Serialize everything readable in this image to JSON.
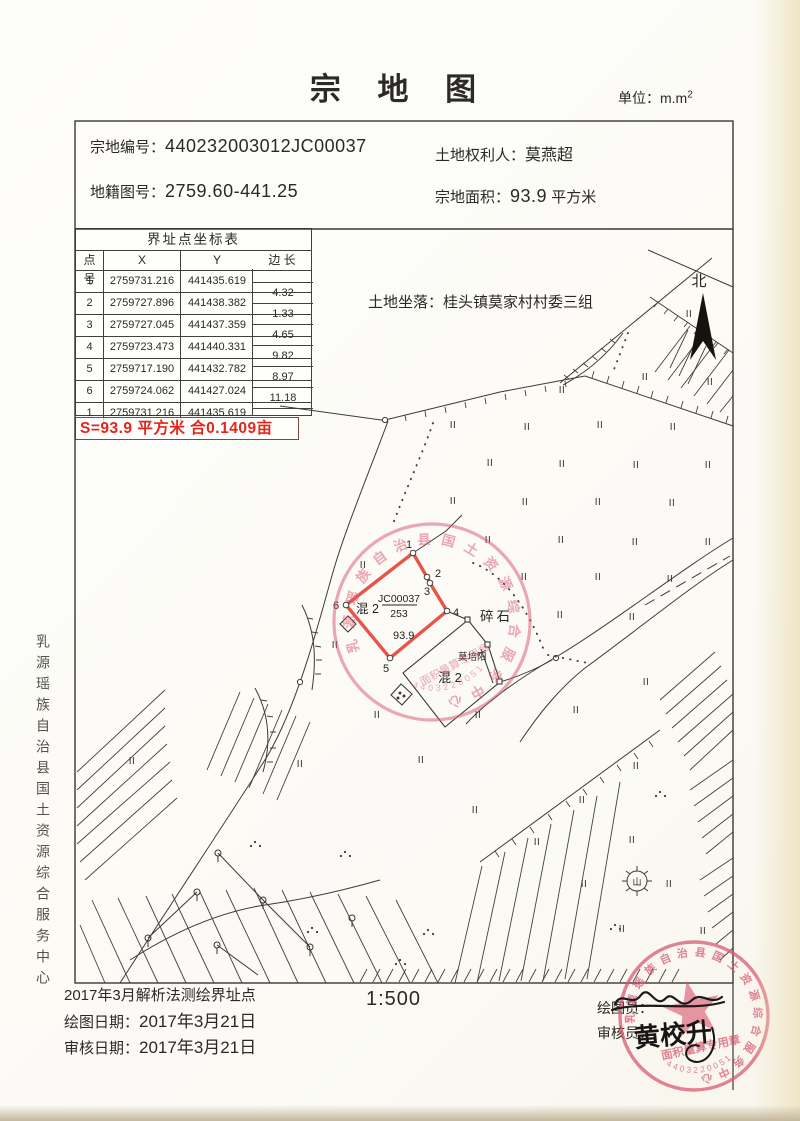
{
  "page": {
    "title": "宗 地 图",
    "unit_label": "单位：m.m",
    "unit_sup": "2"
  },
  "header": {
    "parcel_no_label": "宗地编号：",
    "parcel_no": "440232003012JC00037",
    "holder_label": "土地权利人：",
    "holder": "莫燕超",
    "sheet_no_label": "地籍图号：",
    "sheet_no": "2759.60-441.25",
    "area_label": "宗地面积：",
    "area": "93.9",
    "area_unit": "平方米"
  },
  "table": {
    "title": "界址点坐标表",
    "headers": {
      "pt": "点 号",
      "x": "X",
      "y": "Y",
      "len": "边 长"
    },
    "rows": [
      {
        "pt": "1",
        "x": "2759731.216",
        "y": "441435.619"
      },
      {
        "pt": "2",
        "x": "2759727.896",
        "y": "441438.382"
      },
      {
        "pt": "3",
        "x": "2759727.045",
        "y": "441437.359"
      },
      {
        "pt": "4",
        "x": "2759723.473",
        "y": "441440.331"
      },
      {
        "pt": "5",
        "x": "2759717.190",
        "y": "441432.782"
      },
      {
        "pt": "6",
        "x": "2759724.062",
        "y": "441427.024"
      },
      {
        "pt": "1",
        "x": "2759731.216",
        "y": "441435.619"
      }
    ],
    "edge_lengths": [
      "4.32",
      "1.33",
      "4.65",
      "9.82",
      "8.97",
      "11.18"
    ],
    "summary": "S=93.9 平方米 合0.1409亩"
  },
  "map": {
    "location_label": "土地坐落：",
    "location": "桂头镇莫家村村委三组",
    "north_label": "北",
    "gravel_label": "碎石",
    "hill_label": "山",
    "ii_symbol": "II",
    "parcel": {
      "code": "JC00037",
      "denominator": "253",
      "structure": "混 2",
      "area": "93.9",
      "vertex_labels": [
        "1",
        "2",
        "3",
        "4",
        "5",
        "6"
      ]
    },
    "neighbor": {
      "owner": "莫培阳",
      "structure": "混 2"
    },
    "ii_positions": [
      [
        689,
        317
      ],
      [
        645,
        380
      ],
      [
        710,
        385
      ],
      [
        562,
        393
      ],
      [
        453,
        428
      ],
      [
        527,
        430
      ],
      [
        600,
        428
      ],
      [
        673,
        430
      ],
      [
        490,
        466
      ],
      [
        562,
        467
      ],
      [
        636,
        468
      ],
      [
        708,
        468
      ],
      [
        453,
        504
      ],
      [
        525,
        505
      ],
      [
        598,
        505
      ],
      [
        672,
        506
      ],
      [
        488,
        543
      ],
      [
        561,
        543
      ],
      [
        635,
        545
      ],
      [
        708,
        545
      ],
      [
        524,
        580
      ],
      [
        598,
        580
      ],
      [
        670,
        582
      ],
      [
        560,
        618
      ],
      [
        632,
        620
      ],
      [
        576,
        713
      ],
      [
        646,
        685
      ],
      [
        636,
        769
      ],
      [
        582,
        803
      ],
      [
        537,
        845
      ],
      [
        632,
        843
      ],
      [
        584,
        887
      ],
      [
        669,
        887
      ],
      [
        622,
        932
      ],
      [
        703,
        934
      ],
      [
        478,
        718
      ],
      [
        421,
        763
      ],
      [
        475,
        813
      ],
      [
        363,
        568
      ],
      [
        335,
        648
      ],
      [
        300,
        767
      ],
      [
        377,
        718
      ],
      [
        132,
        764
      ]
    ],
    "poles": [
      [
        218,
        853
      ],
      [
        197,
        892
      ],
      [
        148,
        938
      ],
      [
        217,
        945
      ],
      [
        263,
        900
      ],
      [
        310,
        947
      ],
      [
        352,
        918
      ]
    ],
    "dot_clusters": [
      [
        345,
        852
      ],
      [
        428,
        930
      ],
      [
        255,
        842
      ],
      [
        312,
        928
      ],
      [
        400,
        960
      ],
      [
        660,
        792
      ],
      [
        615,
        925
      ]
    ]
  },
  "sidebar": {
    "org": "乳源瑶族自治县国土资源综合服务中心"
  },
  "footer": {
    "method_note": "2017年3月解析法测绘界址点",
    "draw_date_label": "绘图日期：",
    "draw_date": "2017年3月21日",
    "review_date_label": "审核日期：",
    "review_date": "2017年3月21日",
    "scale": "1:500",
    "drafter_label": "绘图员：",
    "reviewer_label": "审核员：",
    "reviewer_signature": "黄校升"
  },
  "stamps": {
    "ring_text": "乳源瑶族自治县国土资源综合服务中心",
    "inner_text": "面积量算专用章",
    "serial": "4403220051",
    "color": "#d8566e"
  }
}
